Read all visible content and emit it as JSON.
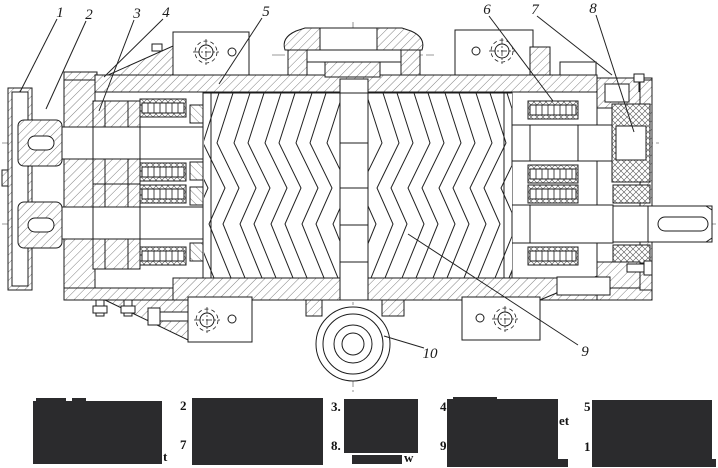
{
  "drawing": {
    "description": "sectional technical drawing of a twin-screw compressor with herringbone rotors, timing gears, bearings, output shaft and bottom drain boss",
    "callouts": [
      {
        "label": "1"
      },
      {
        "label": "2"
      },
      {
        "label": "3"
      },
      {
        "label": "4"
      },
      {
        "label": "5"
      },
      {
        "label": "6"
      },
      {
        "label": "7"
      },
      {
        "label": "8"
      },
      {
        "label": "9"
      },
      {
        "label": "10"
      }
    ]
  },
  "legend": {
    "redaction_color": "#2b2b2d",
    "items": [
      {
        "number": "1",
        "prefix_visible": "",
        "suffix_visible": "t",
        "redacted": true
      },
      {
        "number": "2",
        "prefix_visible": "2",
        "suffix_visible": "",
        "redacted": true
      },
      {
        "number": "3",
        "prefix_visible": "3.",
        "suffix_visible": "",
        "redacted": true
      },
      {
        "number": "4",
        "prefix_visible": "4",
        "suffix_visible": "et",
        "redacted": true
      },
      {
        "number": "5",
        "prefix_visible": "5",
        "suffix_visible": "",
        "redacted": true
      },
      {
        "number": "6",
        "prefix_visible": "",
        "suffix_visible": "",
        "redacted": true
      },
      {
        "number": "7",
        "prefix_visible": "7",
        "suffix_visible": "",
        "redacted": true
      },
      {
        "number": "8",
        "prefix_visible": "8.",
        "suffix_visible": "w",
        "redacted": true
      },
      {
        "number": "9",
        "prefix_visible": "9",
        "suffix_visible": "",
        "redacted": true
      },
      {
        "number": "10",
        "prefix_visible": "1",
        "suffix_visible": "",
        "redacted": true
      }
    ]
  }
}
